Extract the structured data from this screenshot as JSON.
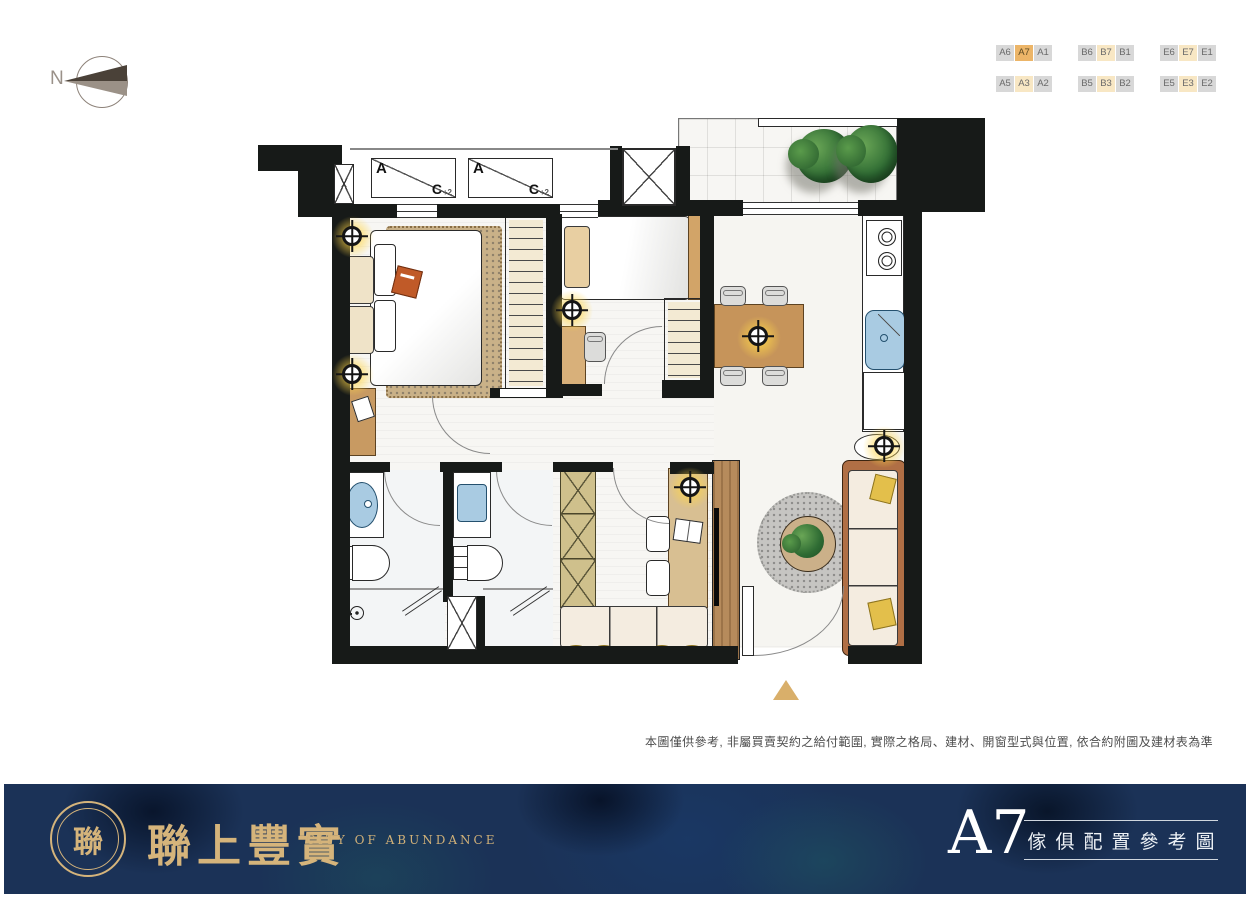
{
  "compass": {
    "label": "N"
  },
  "unit_selector": {
    "selected": "A7",
    "secondary": [
      "B7",
      "E7",
      "A3",
      "B3",
      "E3"
    ],
    "groups": [
      {
        "name": "A",
        "row1": [
          "A6",
          "A7",
          "A1"
        ],
        "row2": [
          "A5",
          "A3",
          "A2"
        ]
      },
      {
        "name": "B",
        "row1": [
          "B6",
          "B7",
          "B1"
        ],
        "row2": [
          "B5",
          "B3",
          "B2"
        ]
      },
      {
        "name": "E",
        "row1": [
          "E6",
          "E7",
          "E1"
        ],
        "row2": [
          "E5",
          "E3",
          "E2"
        ]
      }
    ]
  },
  "plan": {
    "ac_units": [
      {
        "main": "A",
        "corner": "C",
        "sub": "+2"
      },
      {
        "main": "A",
        "corner": "C",
        "sub": "+2"
      }
    ],
    "shaft_label": "X"
  },
  "disclaimer": "本圖僅供參考, 非屬買賣契約之給付範圍, 實際之格局、建材、開窗型式與位置, 依合約附圖及建材表為準",
  "footer": {
    "logo_glyph": "聯",
    "brand": "聯上豐實",
    "brand_en": "CITY OF ABUNDANCE",
    "unit": "A7",
    "caption": "傢俱配置參考圖"
  },
  "colors": {
    "accent_gold": "#d5b47b",
    "navy": "#1b3257",
    "wall": "#171a18",
    "highlight_strong": "#ecb568",
    "highlight_soft": "#f8e7c4",
    "fixture_blue": "#a9cbe2"
  }
}
